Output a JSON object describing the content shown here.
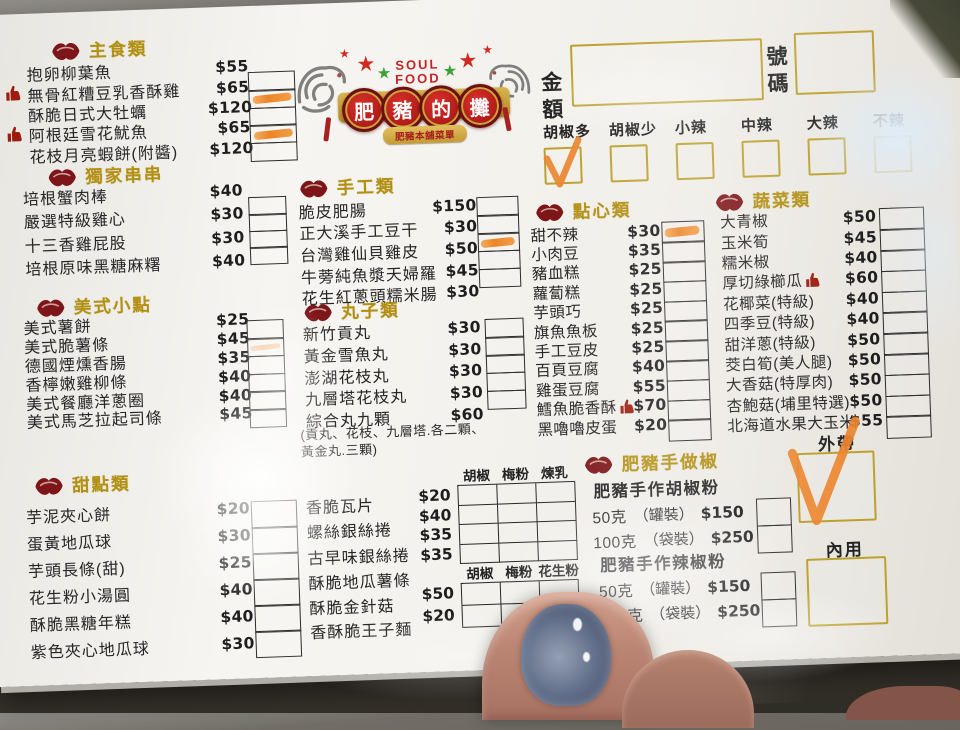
{
  "order_header": {
    "amount_label": "金額",
    "number_label": "號碼",
    "spice_options": [
      {
        "label": "胡椒多",
        "checked": true
      },
      {
        "label": "胡椒少",
        "checked": false
      },
      {
        "label": "小辣",
        "checked": false
      },
      {
        "label": "中辣",
        "checked": false
      },
      {
        "label": "大辣",
        "checked": false
      },
      {
        "label": "不辣",
        "checked": false,
        "faint": true
      }
    ]
  },
  "logo": {
    "title_top": "SOUL",
    "title_bottom": "FOOD",
    "medallion_chars": [
      "肥",
      "豬",
      "的",
      "攤"
    ],
    "banner_text": "肥豬本舖菜單"
  },
  "sections": [
    {
      "id": "main",
      "title": "主食類",
      "items": [
        {
          "name": "抱卵柳葉魚",
          "price": "$55"
        },
        {
          "name": "無骨紅糟豆乳香酥雞",
          "price": "$65",
          "liked": "left",
          "checked": true
        },
        {
          "name": "酥脆日式大牡蠣",
          "price": "$120"
        },
        {
          "name": "阿根廷雪花魷魚",
          "price": "$65",
          "liked": "left",
          "checked": true
        },
        {
          "name": "花枝月亮蝦餅(附醬)",
          "price": "$120"
        }
      ]
    },
    {
      "id": "skewers",
      "title": "獨家串串",
      "items": [
        {
          "name": "培根蟹肉棒",
          "price": "$40"
        },
        {
          "name": "嚴選特級雞心",
          "price": "$30"
        },
        {
          "name": "十三香雞屁股",
          "price": "$30"
        },
        {
          "name": "培根原味黑糖麻糬",
          "price": "$40"
        }
      ]
    },
    {
      "id": "american",
      "title": "美式小點",
      "items": [
        {
          "name": "美式薯餅",
          "price": "$25"
        },
        {
          "name": "美式脆薯條",
          "price": "$45",
          "checked": "faint"
        },
        {
          "name": "德國煙燻香腸",
          "price": "$35"
        },
        {
          "name": "香檸嫩雞柳條",
          "price": "$40"
        },
        {
          "name": "美式餐廳洋蔥圈",
          "price": "$40"
        },
        {
          "name": "美式馬芝拉起司條",
          "price": "$45"
        }
      ]
    },
    {
      "id": "sweets",
      "title": "甜點類",
      "items": [
        {
          "name": "芋泥夾心餅",
          "price": "$20"
        },
        {
          "name": "蛋黃地瓜球",
          "price": "$30"
        },
        {
          "name": "芋頭長條(甜)",
          "price": "$25"
        },
        {
          "name": "花生粉小湯圓",
          "price": "$40"
        },
        {
          "name": "酥脆黑糖年糕",
          "price": "$40"
        },
        {
          "name": "紫色夾心地瓜球",
          "price": "$30"
        }
      ]
    },
    {
      "id": "handmade",
      "title": "手工類",
      "items": [
        {
          "name": "脆皮肥腸",
          "price": "$150"
        },
        {
          "name": "正大溪手工豆干",
          "price": "$30"
        },
        {
          "name": "台灣雞仙貝雞皮",
          "price": "$50",
          "checked": true
        },
        {
          "name": "牛蒡純魚漿天婦羅",
          "price": "$45"
        },
        {
          "name": "花生紅蔥頭糯米腸",
          "price": "$30"
        }
      ]
    },
    {
      "id": "balls",
      "title": "丸子類",
      "items": [
        {
          "name": "新竹貢丸",
          "price": "$30"
        },
        {
          "name": "黃金雪魚丸",
          "price": "$30"
        },
        {
          "name": "澎湖花枝丸",
          "price": "$30"
        },
        {
          "name": "九層塔花枝丸",
          "price": "$30"
        },
        {
          "name": "綜合丸九顆",
          "price": "$60"
        }
      ],
      "note_line1": "(貢丸、花枝、九層塔.各二顆、",
      "note_line2": "黃金丸.三顆)"
    },
    {
      "id": "dimsum",
      "title": "點心類",
      "items": [
        {
          "name": "甜不辣",
          "price": "$30",
          "checked": true
        },
        {
          "name": "小肉豆",
          "price": "$35"
        },
        {
          "name": "豬血糕",
          "price": "$25"
        },
        {
          "name": "蘿蔔糕",
          "price": "$25"
        },
        {
          "name": "芋頭巧",
          "price": "$25"
        },
        {
          "name": "旗魚魚板",
          "price": "$25"
        },
        {
          "name": "手工豆皮",
          "price": "$25"
        },
        {
          "name": "百頁豆腐",
          "price": "$40"
        },
        {
          "name": "雞蛋豆腐",
          "price": "$55"
        },
        {
          "name": "鱈魚脆香酥",
          "price": "$70",
          "liked": "right"
        },
        {
          "name": "黑嚕嚕皮蛋",
          "price": "$20"
        }
      ]
    },
    {
      "id": "vegetables",
      "title": "蔬菜類",
      "items": [
        {
          "name": "大青椒",
          "price": "$50"
        },
        {
          "name": "玉米筍",
          "price": "$45"
        },
        {
          "name": "糯米椒",
          "price": "$40"
        },
        {
          "name": "厚切綠櫛瓜",
          "price": "$60",
          "liked": "right"
        },
        {
          "name": "花椰菜(特級)",
          "price": "$40"
        },
        {
          "name": "四季豆(特級)",
          "price": "$40"
        },
        {
          "name": "甜洋蔥(特級)",
          "price": "$50"
        },
        {
          "name": "茭白筍(美人腿)",
          "price": "$50"
        },
        {
          "name": "大香菇(特厚肉)",
          "price": "$50"
        },
        {
          "name": "杏鮑菇(埔里特選)",
          "price": "$50"
        },
        {
          "name": "北海道水果大玉米",
          "price": "$55"
        }
      ]
    }
  ],
  "crispy_groups": [
    {
      "topping_headers": [
        "胡椒",
        "梅粉",
        "煉乳"
      ],
      "items": [
        {
          "name": "香脆瓦片",
          "price": "$20"
        },
        {
          "name": "螺絲銀絲捲",
          "price": "$40"
        },
        {
          "name": "古早味銀絲捲",
          "price": "$35"
        },
        {
          "name": "酥脆地瓜薯條",
          "price": "$35"
        }
      ]
    },
    {
      "topping_headers": [
        "胡椒",
        "梅粉",
        "花生粉"
      ],
      "items": [
        {
          "name": "酥脆金針菇",
          "price": "$50"
        },
        {
          "name": "香酥脆王子麵",
          "price": "$20"
        }
      ]
    }
  ],
  "powders": {
    "title": "肥豬手做椒",
    "groups": [
      {
        "name": "肥豬手作胡椒粉",
        "rows": [
          {
            "qty": "50克",
            "pack": "（罐裝）",
            "price": "$150"
          },
          {
            "qty": "100克",
            "pack": "（袋裝）",
            "price": "$250"
          }
        ]
      },
      {
        "name": "肥豬手作辣椒粉",
        "rows": [
          {
            "qty": "50克",
            "pack": "（罐裝）",
            "price": "$150"
          },
          {
            "qty": "100克",
            "pack": "（袋裝）",
            "price": "$250"
          }
        ]
      }
    ]
  },
  "service": {
    "takeout_label": "外帶",
    "takeout_checked": true,
    "dinein_label": "內用",
    "dinein_checked": false
  },
  "colors": {
    "accent_gold": "#b3900f",
    "gold_border": "#bda12f",
    "highlighter_orange": "#ec7f1c",
    "stamp_red": "#9e1b10"
  }
}
